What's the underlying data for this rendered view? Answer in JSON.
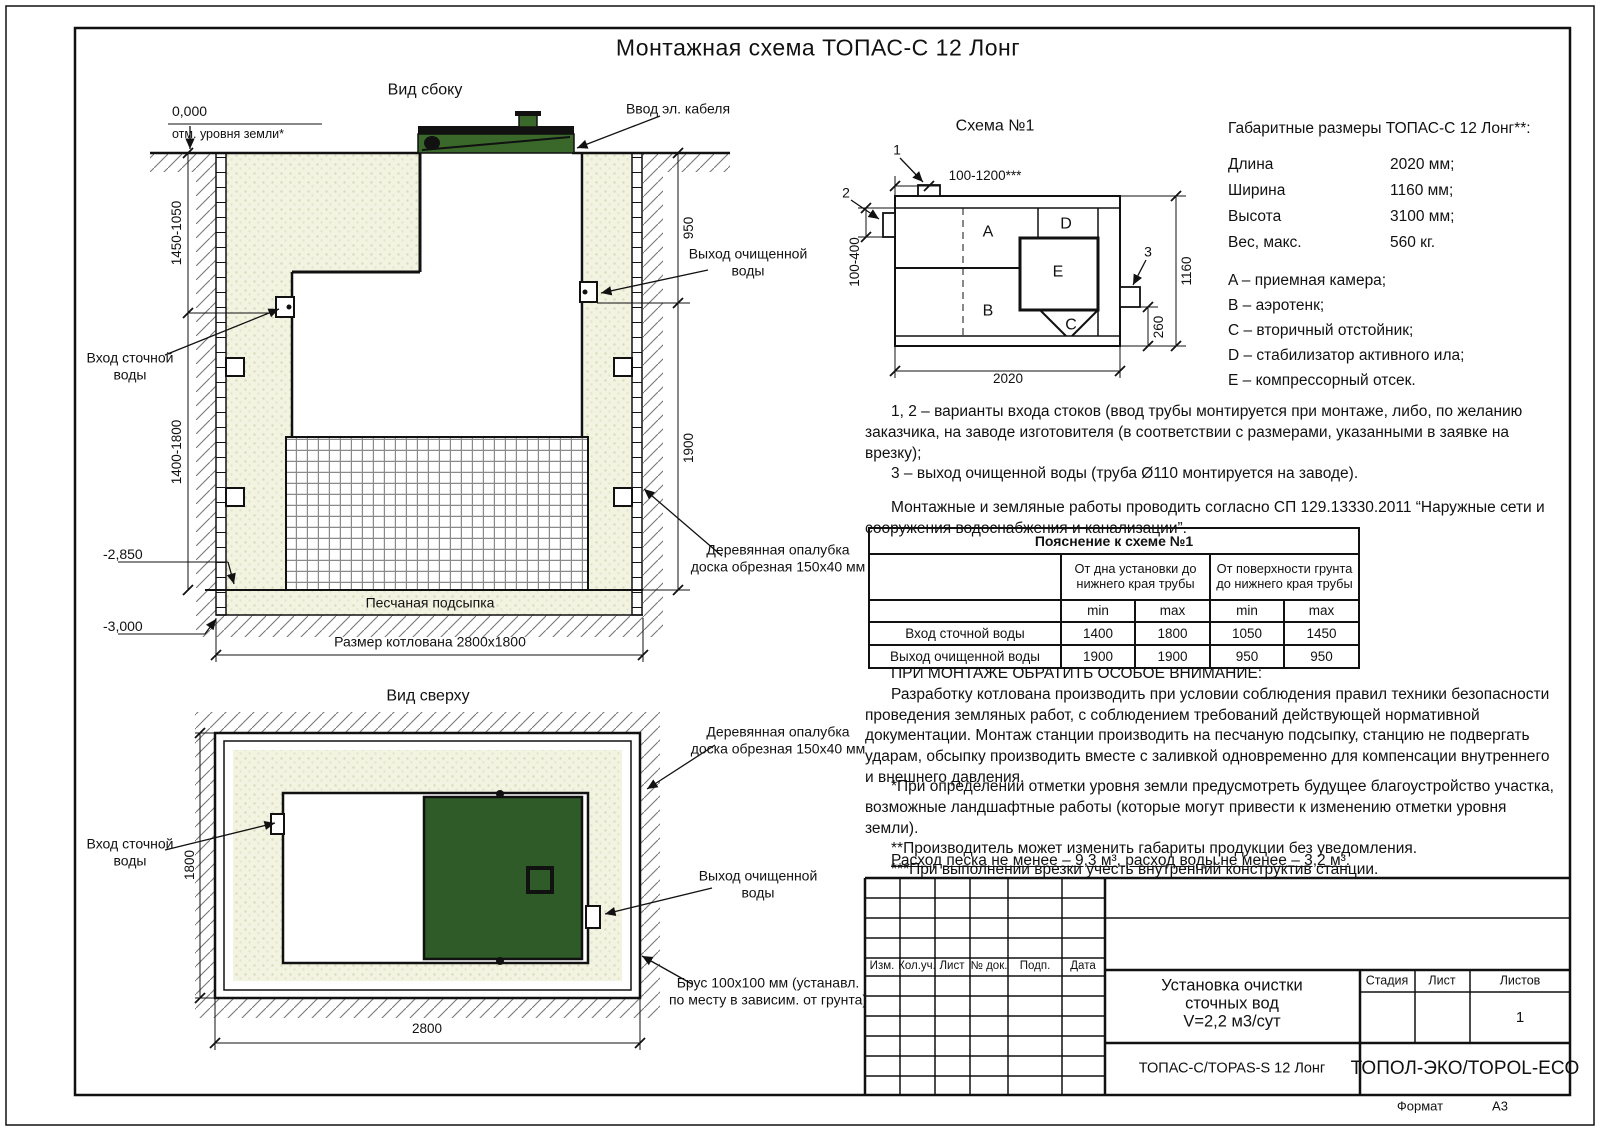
{
  "title": "Монтажная схема ТОПАС-С 12 Лонг",
  "colors": {
    "lid_green": "#3a682b",
    "lid_green_top": "#2e5b27",
    "sand": "#f3f3e2",
    "line": "#111111"
  },
  "side_view": {
    "title": "Вид сбоку",
    "zero_mark": "0,000",
    "ground_note": "отм. уровня земли*",
    "cable_label": "Ввод эл. кабеля",
    "outlet_label": "Выход очищенной воды",
    "inlet_label": "Вход сточной воды",
    "formwork_label": "Деревянная опалубка доска обрезная 150x40 мм",
    "bedding_label": "Песчаная подсыпка",
    "pit_size_label": "Размер котлована 2800x1800",
    "level_2850": "-2,850",
    "level_3000": "-3,000",
    "dim_left_upper": "1450-1050",
    "dim_left_lower": "1400-1800",
    "dim_right_upper": "950",
    "dim_right_lower": "1900"
  },
  "top_view": {
    "title": "Вид сверху",
    "inlet_label": "Вход сточной воды",
    "outlet_label": "Выход очищенной воды",
    "formwork_label": "Деревянная опалубка доска обрезная 150x40 мм",
    "beam_label": "Брус 100x100 мм (устанавл. по месту в зависим. от грунта)",
    "dim_width": "2800",
    "dim_height": "1800"
  },
  "schema": {
    "title": "Схема №1",
    "comp_a": "A",
    "comp_b": "B",
    "comp_c": "C",
    "comp_d": "D",
    "comp_e": "E",
    "callout_1": "1",
    "callout_2": "2",
    "callout_3": "3",
    "dim_top": "100-1200***",
    "dim_left": "100-400",
    "dim_right": "1160",
    "dim_outlet": "260",
    "dim_bottom": "2020"
  },
  "specs": {
    "title": "Габаритные размеры ТОПАС-С 12 Лонг**:",
    "rows": [
      {
        "label": "Длина",
        "value": "2020 мм;"
      },
      {
        "label": "Ширина",
        "value": "1160 мм;"
      },
      {
        "label": "Высота",
        "value": "3100 мм;"
      },
      {
        "label": "Вес, макс.",
        "value": "560 кг."
      }
    ],
    "legend": [
      "A – приемная камера;",
      "B – аэротенк;",
      "C – вторичный отстойник;",
      "D – стабилизатор активного ила;",
      "E – компрессорный отсек."
    ]
  },
  "notes": {
    "variant_1": "1, 2 – варианты входа  стоков (ввод трубы монтируется при монтаже, либо, по желанию заказчика, на заводе изготовителя (в соответствии с размерами, указанными в заявке на врезку);",
    "variant_2": "3 – выход очищенной воды (труба Ø110 монтируется на заводе).",
    "sp": "Монтажные и земляные работы проводить согласно СП 129.13330.2011 “Наружные сети и сооружения водоснабжения и канализации”."
  },
  "table": {
    "title": "Пояснение к схеме №1",
    "group_1": "От дна установки до нижнего края трубы",
    "group_2": "От поверхности грунта до нижнего края трубы",
    "min_label": "min",
    "max_label": "max",
    "rows": [
      {
        "label": "Вход сточной воды",
        "values": [
          "1400",
          "1800",
          "1050",
          "1450"
        ]
      },
      {
        "label": "Выход очищенной воды",
        "values": [
          "1900",
          "1900",
          "950",
          "950"
        ]
      }
    ]
  },
  "warning": {
    "heading": "ПРИ МОНТАЖЕ ОБРАТИТЬ ОСОБОЕ ВНИМАНИЕ:",
    "body": "Разработку котлована производить при условии соблюдения правил техники безопасности проведения земляных работ, с соблюдением требований действующей нормативной документации. Монтаж станции производить на песчаную подсыпку, станцию не подвергать ударам, обсыпку производить вместе с заливкой одновременно для компенсации внутреннего и внешнего давления."
  },
  "footnotes": [
    "*При определении отметки уровня земли предусмотреть будущее благоустройство участка, возможные ландшафтные работы (которые могут привести к изменению отметки уровня земли).",
    "**Производитель может изменить габариты продукции без уведомления.",
    "***При выполнении врезки учесть внутренний конструктив станции."
  ],
  "consumption": "Расход песка не менее – 9,3 м³, расход воды не менее – 3,2 м³.",
  "title_block": {
    "columns": [
      "Изм.",
      "Кол.уч.",
      "Лист",
      "№ док.",
      "Подп.",
      "Дата"
    ],
    "project_lines": [
      "Установка очистки",
      "сточных вод",
      "V=2,2 м3/сут"
    ],
    "stage_label": "Стадия",
    "sheet_label": "Лист",
    "sheets_label": "Листов",
    "sheets_value": "1",
    "model": "ТОПАС-С/TOPAS-S 12 Лонг",
    "company": "ТОПОЛ-ЭКО/TOPOL-ECO",
    "format_label": "Формат",
    "format_value": "А3"
  }
}
